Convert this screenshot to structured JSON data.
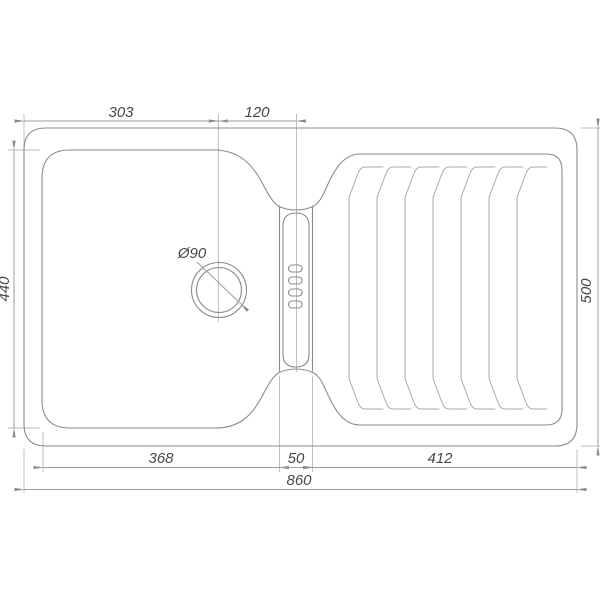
{
  "dimensions": {
    "edge_to_drain_center": "303",
    "drain_center_to_channel": "120",
    "bowl_inner_height": "440",
    "overall_height": "500",
    "bowl_inner_width": "368",
    "channel_width": "50",
    "drainboard_width": "412",
    "overall_width": "860",
    "drain_diameter": "Ø90"
  },
  "drainboard": {
    "ridge_count": 7
  },
  "channel": {
    "slot_count": 4
  },
  "colors": {
    "outline": "#8b8b8b",
    "ridge_line": "#a9a9a9",
    "dimension_line": "#9d9d9d",
    "extension_line": "#b9b9b9",
    "text": "#474747",
    "background": "#ffffff"
  }
}
